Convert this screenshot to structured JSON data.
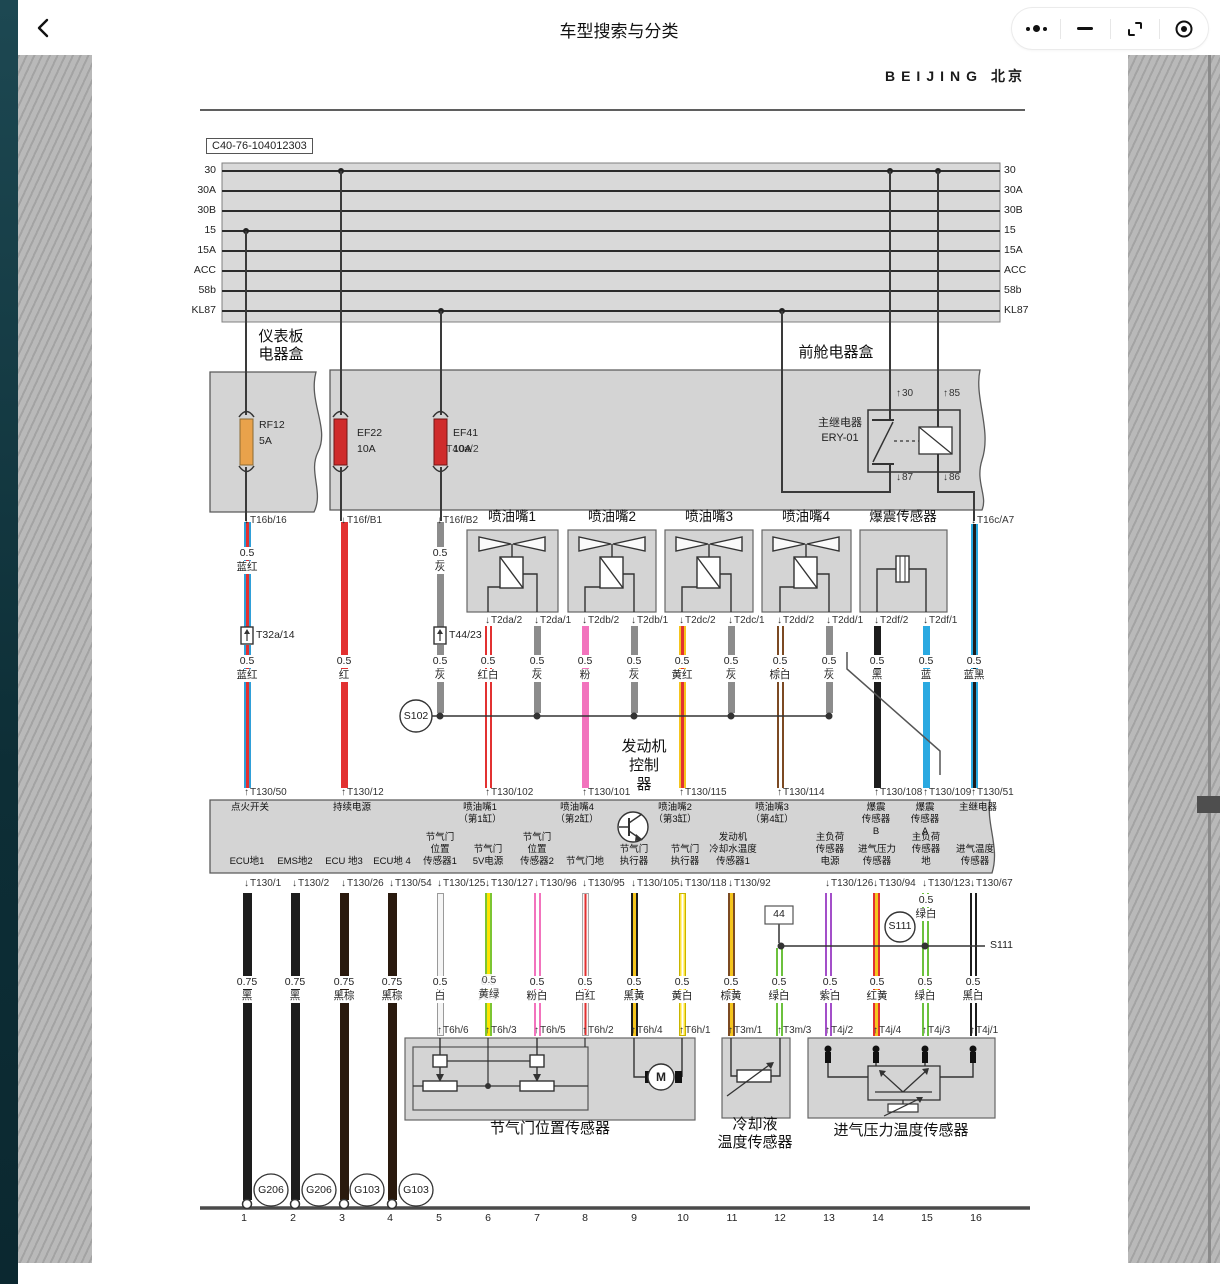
{
  "header": {
    "title": "车型搜索与分类",
    "back_icon": "chevron-left-icon",
    "capsule_icons": [
      "more-icon",
      "minimize-icon",
      "fullscreen-icon",
      "record-icon"
    ]
  },
  "page": {
    "brand_en": "BEIJING",
    "brand_cn": "北京",
    "doc_code": "C40-76-104012303"
  },
  "diagram": {
    "bus_rows": [
      "30",
      "30A",
      "30B",
      "15",
      "15A",
      "ACC",
      "58b",
      "KL87"
    ],
    "palette": {
      "蓝红": [
        "#2f9fd8",
        "#e23131"
      ],
      "红": [
        "#e23131",
        null
      ],
      "灰": [
        "#8c8c8c",
        null
      ],
      "红白": [
        "#e23131",
        "#ffffff"
      ],
      "粉": [
        "#f273bd",
        null
      ],
      "黄红": [
        "#f5c51d",
        "#e23131"
      ],
      "棕白": [
        "#7c4a23",
        "#ffffff"
      ],
      "黑": [
        "#1d1d1d",
        null
      ],
      "蓝": [
        "#2aa9e1",
        null
      ],
      "蓝黑": [
        "#2aa9e1",
        "#1d1d1d"
      ],
      "黑棕": [
        "#2a1a0e",
        null
      ],
      "白": [
        "#f5f5f5",
        null,
        "#9a9a9a"
      ],
      "黄绿": [
        "#7cc532",
        "#ffe400"
      ],
      "粉白": [
        "#f273bd",
        "#ffffff"
      ],
      "白红": [
        "#f7f7f7",
        "#e23131",
        "#aaaaaa"
      ],
      "黑黄": [
        "#1d1d1d",
        "#f5c51d"
      ],
      "黄白": [
        "#ffe43a",
        "#ffffff",
        "#c8b500"
      ],
      "棕黄": [
        "#7c4a23",
        "#f5c51d"
      ],
      "绿白": [
        "#6cc13e",
        "#ffffff"
      ],
      "紫白": [
        "#a34fc9",
        "#ffffff"
      ],
      "红黄": [
        "#e23131",
        "#f5c51d"
      ],
      "黑白": [
        "#1d1d1d",
        "#ffffff"
      ]
    },
    "wires": [
      [
        247,
        522,
        627,
        "蓝红"
      ],
      [
        247,
        645,
        788,
        "蓝红"
      ],
      [
        344,
        522,
        788,
        "红"
      ],
      [
        440,
        522,
        627,
        "灰"
      ],
      [
        440,
        645,
        713,
        "灰"
      ],
      [
        488,
        626,
        788,
        "红白"
      ],
      [
        537,
        626,
        713,
        "灰"
      ],
      [
        585,
        626,
        788,
        "粉"
      ],
      [
        634,
        626,
        713,
        "灰"
      ],
      [
        682,
        626,
        788,
        "黄红"
      ],
      [
        731,
        626,
        713,
        "灰"
      ],
      [
        780,
        626,
        788,
        "棕白"
      ],
      [
        829,
        626,
        713,
        "灰"
      ],
      [
        877,
        626,
        788,
        "黑"
      ],
      [
        926,
        626,
        788,
        "蓝"
      ],
      [
        974,
        524,
        788,
        "蓝黑"
      ],
      [
        247,
        893,
        1200,
        "黑",
        9
      ],
      [
        295,
        893,
        1200,
        "黑",
        9
      ],
      [
        344,
        893,
        1200,
        "黑棕",
        9
      ],
      [
        392,
        893,
        1200,
        "黑棕",
        9
      ],
      [
        440,
        893,
        1036,
        "白"
      ],
      [
        488,
        893,
        1036,
        "黄绿"
      ],
      [
        537,
        893,
        1036,
        "粉白"
      ],
      [
        585,
        893,
        1036,
        "白红"
      ],
      [
        634,
        893,
        1036,
        "黑黄"
      ],
      [
        682,
        893,
        1036,
        "黄白"
      ],
      [
        731,
        893,
        1036,
        "棕黄"
      ],
      [
        779,
        948,
        1036,
        "绿白"
      ],
      [
        828,
        893,
        1036,
        "紫白"
      ],
      [
        876,
        893,
        1036,
        "红黄"
      ],
      [
        925,
        893,
        1036,
        "绿白"
      ],
      [
        973,
        893,
        1036,
        "黑白"
      ]
    ],
    "terminal_groups": [
      {
        "y": 514,
        "dir": "dn",
        "items": [
          [
            247,
            "T16b/16"
          ],
          [
            344,
            "T16f/B1"
          ],
          [
            440,
            "T16f/B2"
          ],
          [
            974,
            "T16c/A7"
          ]
        ]
      },
      {
        "y": 614,
        "dir": "dn",
        "items": [
          [
            488,
            "T2da/2"
          ],
          [
            537,
            "T2da/1"
          ],
          [
            585,
            "T2db/2"
          ],
          [
            634,
            "T2db/1"
          ],
          [
            682,
            "T2dc/2"
          ],
          [
            731,
            "T2dc/1"
          ],
          [
            780,
            "T2dd/2"
          ],
          [
            829,
            "T2dd/1"
          ],
          [
            877,
            "T2df/2"
          ],
          [
            926,
            "T2df/1"
          ]
        ]
      },
      {
        "y": 786,
        "dir": "up",
        "items": [
          [
            247,
            "T130/50"
          ],
          [
            344,
            "T130/12"
          ],
          [
            488,
            "T130/102"
          ],
          [
            585,
            "T130/101"
          ],
          [
            682,
            "T130/115"
          ],
          [
            780,
            "T130/114"
          ],
          [
            877,
            "T130/108"
          ],
          [
            926,
            "T130/109"
          ],
          [
            974,
            "T130/51"
          ]
        ]
      },
      {
        "y": 877,
        "dir": "dn",
        "items": [
          [
            247,
            "T130/1"
          ],
          [
            295,
            "T130/2"
          ],
          [
            344,
            "T130/26"
          ],
          [
            392,
            "T130/54"
          ],
          [
            440,
            "T130/125"
          ],
          [
            488,
            "T130/127"
          ],
          [
            537,
            "T130/96"
          ],
          [
            585,
            "T130/95"
          ],
          [
            634,
            "T130/105"
          ],
          [
            682,
            "T130/118"
          ],
          [
            731,
            "T130/92"
          ],
          [
            828,
            "T130/126"
          ],
          [
            876,
            "T130/94"
          ],
          [
            925,
            "T130/123"
          ],
          [
            973,
            "T130/67"
          ]
        ]
      },
      {
        "y": 1024,
        "dir": "up",
        "items": [
          [
            440,
            "T6h/6"
          ],
          [
            488,
            "T6h/3"
          ],
          [
            537,
            "T6h/5"
          ],
          [
            585,
            "T6h/2"
          ],
          [
            634,
            "T6h/4"
          ],
          [
            682,
            "T6h/1"
          ],
          [
            731,
            "T3m/1"
          ],
          [
            780,
            "T3m/3"
          ],
          [
            828,
            "T4j/2"
          ],
          [
            876,
            "T4j/4"
          ],
          [
            925,
            "T4j/3"
          ],
          [
            973,
            "T4j/1"
          ]
        ]
      }
    ],
    "wire_label_groups": [
      {
        "y": 547,
        "items": [
          [
            247,
            "0.5",
            "蓝红"
          ],
          [
            440,
            "0.5",
            "灰"
          ]
        ]
      },
      {
        "y": 655,
        "items": [
          [
            247,
            "0.5",
            "蓝红"
          ],
          [
            344,
            "0.5",
            "红"
          ],
          [
            440,
            "0.5",
            "灰"
          ],
          [
            488,
            "0.5",
            "红白"
          ],
          [
            537,
            "0.5",
            "灰"
          ],
          [
            585,
            "0.5",
            "粉"
          ],
          [
            634,
            "0.5",
            "灰"
          ],
          [
            682,
            "0.5",
            "黄红"
          ],
          [
            731,
            "0.5",
            "灰"
          ],
          [
            780,
            "0.5",
            "棕白"
          ],
          [
            829,
            "0.5",
            "灰"
          ],
          [
            877,
            "0.5",
            "黑"
          ],
          [
            926,
            "0.5",
            "蓝"
          ],
          [
            974,
            "0.5",
            "蓝黑"
          ]
        ]
      },
      {
        "y": 976,
        "items": [
          [
            247,
            "0.75",
            "黑"
          ],
          [
            295,
            "0.75",
            "黑"
          ],
          [
            344,
            "0.75",
            "黑棕"
          ],
          [
            392,
            "0.75",
            "黑棕"
          ],
          [
            440,
            "0.5",
            "白"
          ],
          [
            488,
            "0.5",
            "黄绿",
            "dup"
          ],
          [
            537,
            "0.5",
            "粉白"
          ],
          [
            585,
            "0.5",
            "白红"
          ],
          [
            634,
            "0.5",
            "黑黄"
          ],
          [
            682,
            "0.5",
            "黄白"
          ],
          [
            731,
            "0.5",
            "棕黄"
          ],
          [
            779,
            "0.5",
            "绿白"
          ],
          [
            830,
            "0.5",
            "紫白"
          ],
          [
            877,
            "0.5",
            "红黄"
          ],
          [
            925,
            "0.5",
            "绿白"
          ],
          [
            973,
            "0.5",
            "黑白"
          ]
        ]
      },
      {
        "y": 894,
        "items": [
          [
            926,
            "0.5",
            "绿白"
          ]
        ]
      }
    ],
    "component_titles": {
      "y": 510,
      "items": [
        [
          512,
          "喷油嘴1"
        ],
        [
          612,
          "喷油嘴2"
        ],
        [
          709,
          "喷油嘴3"
        ],
        [
          806,
          "喷油嘴4"
        ],
        [
          903,
          "爆震传感器"
        ]
      ]
    },
    "ecu_top_pins": [
      {
        "x": 250,
        "lines": [
          "点火开关"
        ]
      },
      {
        "x": 352,
        "lines": [
          "持续电源"
        ]
      },
      {
        "x": 480,
        "lines": [
          "喷油嘴1",
          "（第1缸）"
        ]
      },
      {
        "x": 577,
        "lines": [
          "喷油嘴4",
          "（第2缸）"
        ]
      },
      {
        "x": 675,
        "lines": [
          "喷油嘴2",
          "（第3缸）"
        ]
      },
      {
        "x": 772,
        "lines": [
          "喷油嘴3",
          "（第4缸）"
        ]
      },
      {
        "x": 876,
        "lines": [
          "爆震",
          "传感器",
          "B"
        ]
      },
      {
        "x": 925,
        "lines": [
          "爆震",
          "传感器",
          "A"
        ]
      },
      {
        "x": 978,
        "lines": [
          "主继电器"
        ]
      }
    ],
    "ecu_bottom_pins": [
      {
        "x": 247,
        "lines": [
          "ECU地1"
        ]
      },
      {
        "x": 295,
        "lines": [
          "EMS地2"
        ]
      },
      {
        "x": 344,
        "lines": [
          "ECU 地3"
        ]
      },
      {
        "x": 392,
        "lines": [
          "ECU地 4"
        ]
      },
      {
        "x": 440,
        "lines": [
          "节气门",
          "位置",
          "传感器1"
        ]
      },
      {
        "x": 488,
        "lines": [
          "节气门",
          "5V电源"
        ]
      },
      {
        "x": 537,
        "lines": [
          "节气门",
          "位置",
          "传感器2"
        ]
      },
      {
        "x": 585,
        "lines": [
          "节气门地"
        ]
      },
      {
        "x": 634,
        "lines": [
          "节气门",
          "执行器"
        ]
      },
      {
        "x": 685,
        "lines": [
          "节气门",
          "执行器"
        ]
      },
      {
        "x": 733,
        "lines": [
          "发动机",
          "冷却水温度",
          "传感器1"
        ]
      },
      {
        "x": 830,
        "lines": [
          "主负荷",
          "传感器",
          "电源"
        ]
      },
      {
        "x": 877,
        "lines": [
          "进气压力",
          "传感器"
        ]
      },
      {
        "x": 926,
        "lines": [
          "主负荷",
          "传感器",
          "地"
        ]
      },
      {
        "x": 975,
        "lines": [
          "进气温度",
          "传感器"
        ]
      }
    ],
    "misc_labels": [
      [
        259,
        419,
        "RF12",
        "",
        "fuse-label"
      ],
      [
        259,
        435,
        "5A",
        "",
        "fuse-label"
      ],
      [
        357,
        427,
        "EF22",
        "",
        "fuse-label"
      ],
      [
        357,
        443,
        "10A",
        "",
        "fuse-label"
      ],
      [
        453,
        427,
        "EF41",
        "",
        "fuse-label"
      ],
      [
        446,
        443,
        "T40a/2",
        "ghost",
        "connector-label"
      ],
      [
        453,
        443,
        "10A",
        "",
        "fuse-label"
      ],
      [
        840,
        417,
        "主继电器",
        "c f11",
        "relay-title"
      ],
      [
        840,
        432,
        "ERY-01",
        "c f11",
        "relay-title"
      ],
      [
        896,
        387,
        "30",
        "tl up",
        "relay-pin-label"
      ],
      [
        943,
        387,
        "85",
        "tl up",
        "relay-pin-label"
      ],
      [
        896,
        471,
        "87",
        "tl dn",
        "relay-pin-label"
      ],
      [
        943,
        471,
        "86",
        "tl dn",
        "relay-pin-label"
      ],
      [
        256,
        629,
        "T32a/14",
        "",
        "connector-label"
      ],
      [
        449,
        629,
        "T44/23",
        "",
        "connector-label"
      ],
      [
        416,
        710,
        "S102",
        "c",
        "splice-label"
      ],
      [
        900,
        920,
        "S111",
        "c",
        "splice-label"
      ],
      [
        779,
        908,
        "44",
        "c",
        "node-label"
      ],
      [
        990,
        939,
        "S111",
        "",
        "splice-ref-label"
      ],
      [
        281,
        330,
        "仪表板",
        "c big",
        "box-title"
      ],
      [
        281,
        348,
        "电器盒",
        "c big",
        "box-title"
      ],
      [
        836,
        346,
        "前舱电器盒",
        "c big",
        "box-title"
      ],
      [
        644,
        740,
        "发动机",
        "c big",
        "ecu-title"
      ],
      [
        644,
        759,
        "控制",
        "c big",
        "ecu-title"
      ],
      [
        644,
        778,
        "器",
        "c big",
        "ecu-title"
      ],
      [
        550,
        1122,
        "节气门位置传感器",
        "c big",
        "sensor-title"
      ],
      [
        755,
        1118,
        "冷却液",
        "c big",
        "sensor-title"
      ],
      [
        755,
        1136,
        "温度传感器",
        "c big",
        "sensor-title"
      ],
      [
        901,
        1124,
        "进气压力温度传感器",
        "c big",
        "sensor-title"
      ],
      [
        271,
        1184,
        "G206",
        "c",
        "ground-label"
      ],
      [
        319,
        1184,
        "G206",
        "c",
        "ground-label"
      ],
      [
        367,
        1184,
        "G103",
        "c",
        "ground-label"
      ],
      [
        416,
        1184,
        "G103",
        "c",
        "ground-label"
      ],
      [
        661,
        1071,
        "M",
        "c f12",
        "motor-label"
      ]
    ],
    "scale": {
      "y": 1212,
      "items": [
        [
          244,
          "1"
        ],
        [
          293,
          "2"
        ],
        [
          342,
          "3"
        ],
        [
          390,
          "4"
        ],
        [
          439,
          "5"
        ],
        [
          488,
          "6"
        ],
        [
          537,
          "7"
        ],
        [
          585,
          "8"
        ],
        [
          634,
          "9"
        ],
        [
          683,
          "10"
        ],
        [
          732,
          "11"
        ],
        [
          780,
          "12"
        ],
        [
          829,
          "13"
        ],
        [
          878,
          "14"
        ],
        [
          927,
          "15"
        ],
        [
          976,
          "16"
        ]
      ]
    }
  }
}
